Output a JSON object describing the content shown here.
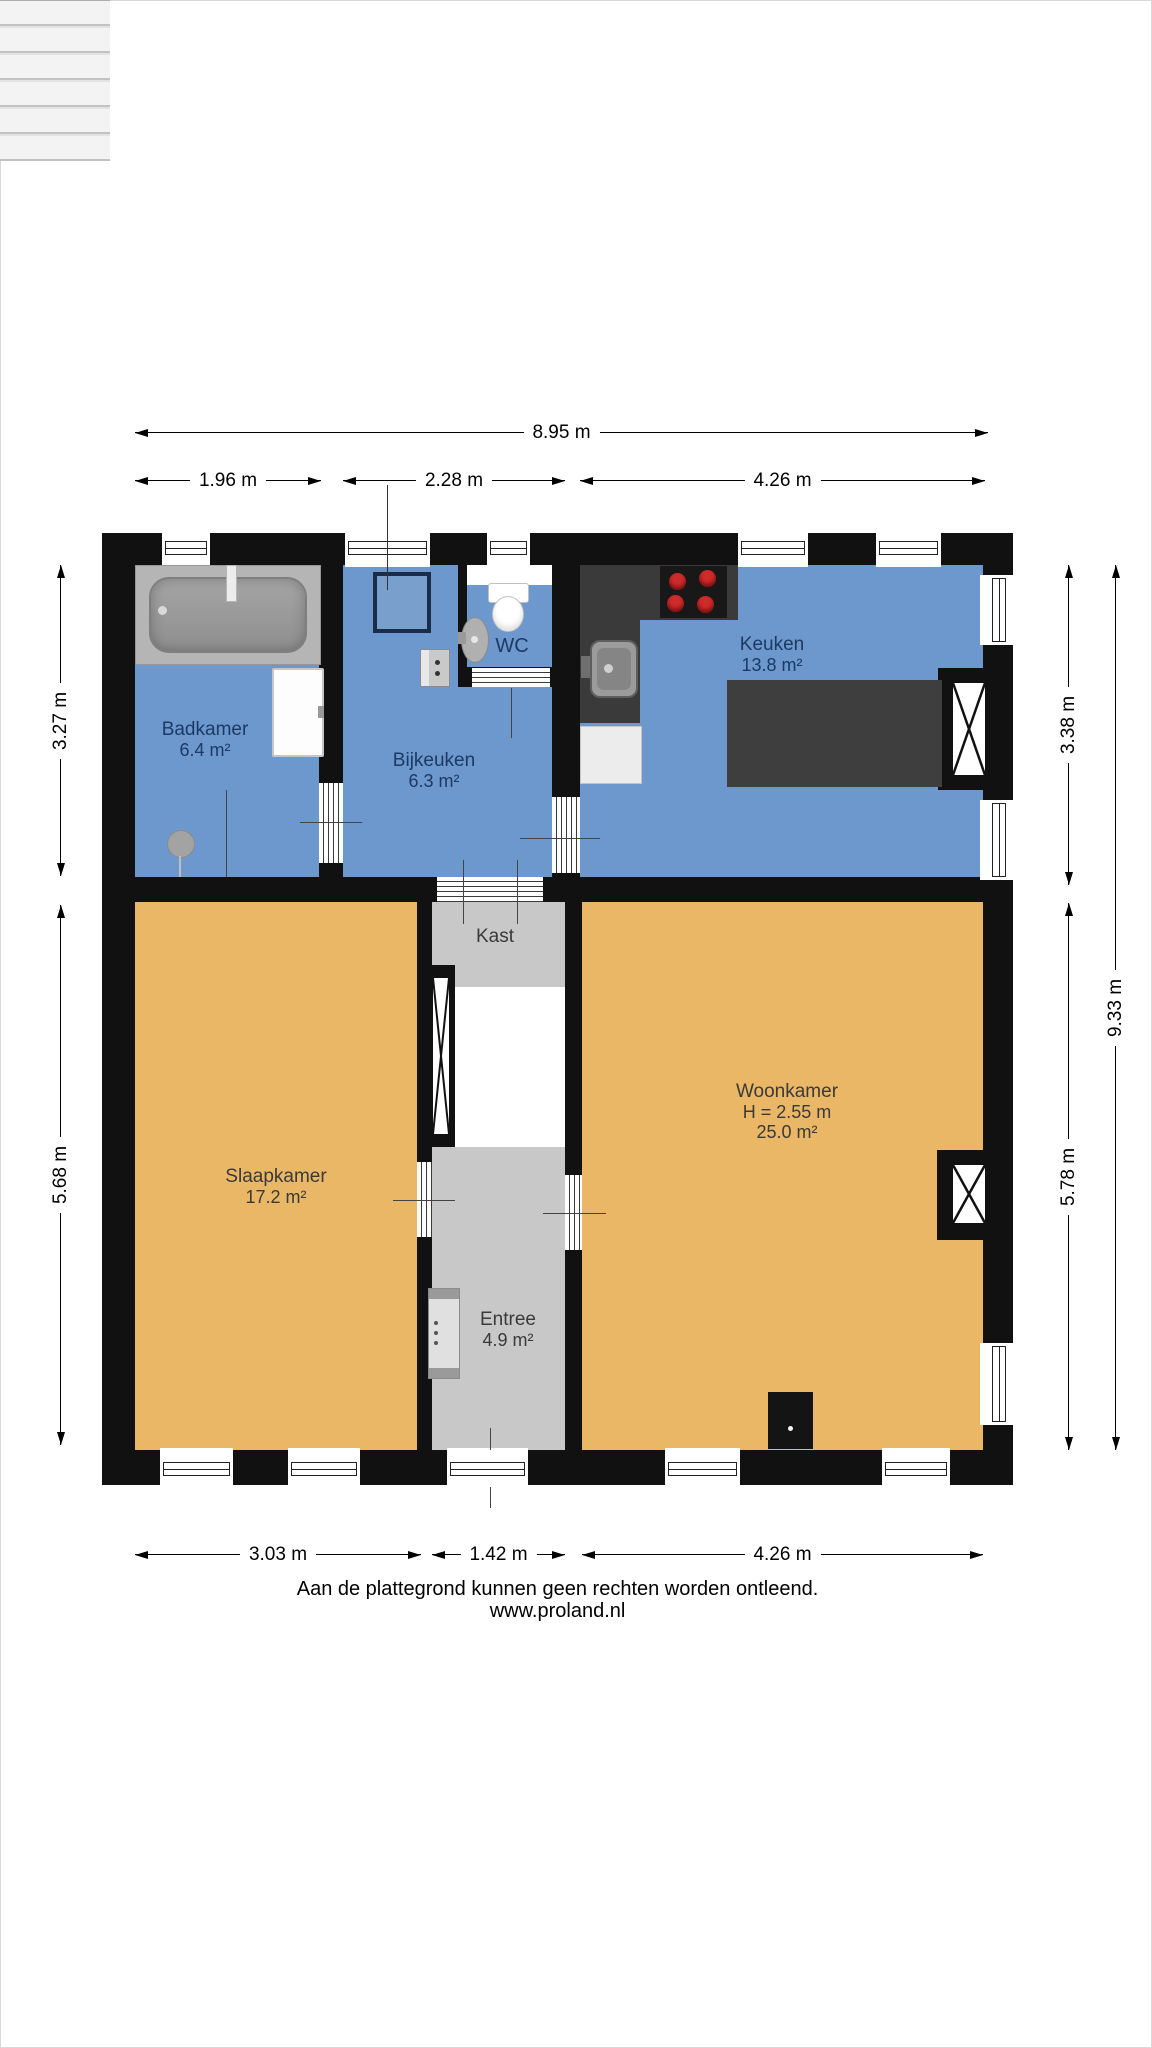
{
  "rooms": [
    {
      "name": "Badkamer",
      "area": "6.4 m²"
    },
    {
      "name": "Bijkeuken",
      "area": "6.3 m²"
    },
    {
      "name": "WC"
    },
    {
      "name": "Keuken",
      "area": "13.8 m²"
    },
    {
      "name": "Kast"
    },
    {
      "name": "Slaapkamer",
      "area": "17.2 m²"
    },
    {
      "name": "Woonkamer",
      "ceiling_height": "H = 2.55 m",
      "area": "25.0 m²"
    },
    {
      "name": "Entree",
      "area": "4.9 m²"
    }
  ],
  "dimensions": {
    "top_total": "8.95 m",
    "top_segments": [
      "1.96 m",
      "2.28 m",
      "4.26 m"
    ],
    "left_segments": [
      "3.27 m",
      "5.68 m"
    ],
    "right_segments": [
      "3.38 m",
      "5.78 m"
    ],
    "right_total": "9.33 m",
    "bottom_segments": [
      "3.03 m",
      "1.42 m",
      "4.26 m"
    ]
  },
  "footer": {
    "disclaimer": "Aan de plattegrond kunnen geen rechten worden ontleend.",
    "website": "www.proland.nl"
  },
  "colors": {
    "wet_room_blue": "#6c98ce",
    "living_room_orange": "#e9b766",
    "hall_gray": "#c8c8c8",
    "wall_black": "#111111",
    "counter_dark": "#3a3a3a",
    "burner_red": "#d02c2c",
    "label_navy": "#1c3a63",
    "label_dark": "#3a3a3a"
  }
}
